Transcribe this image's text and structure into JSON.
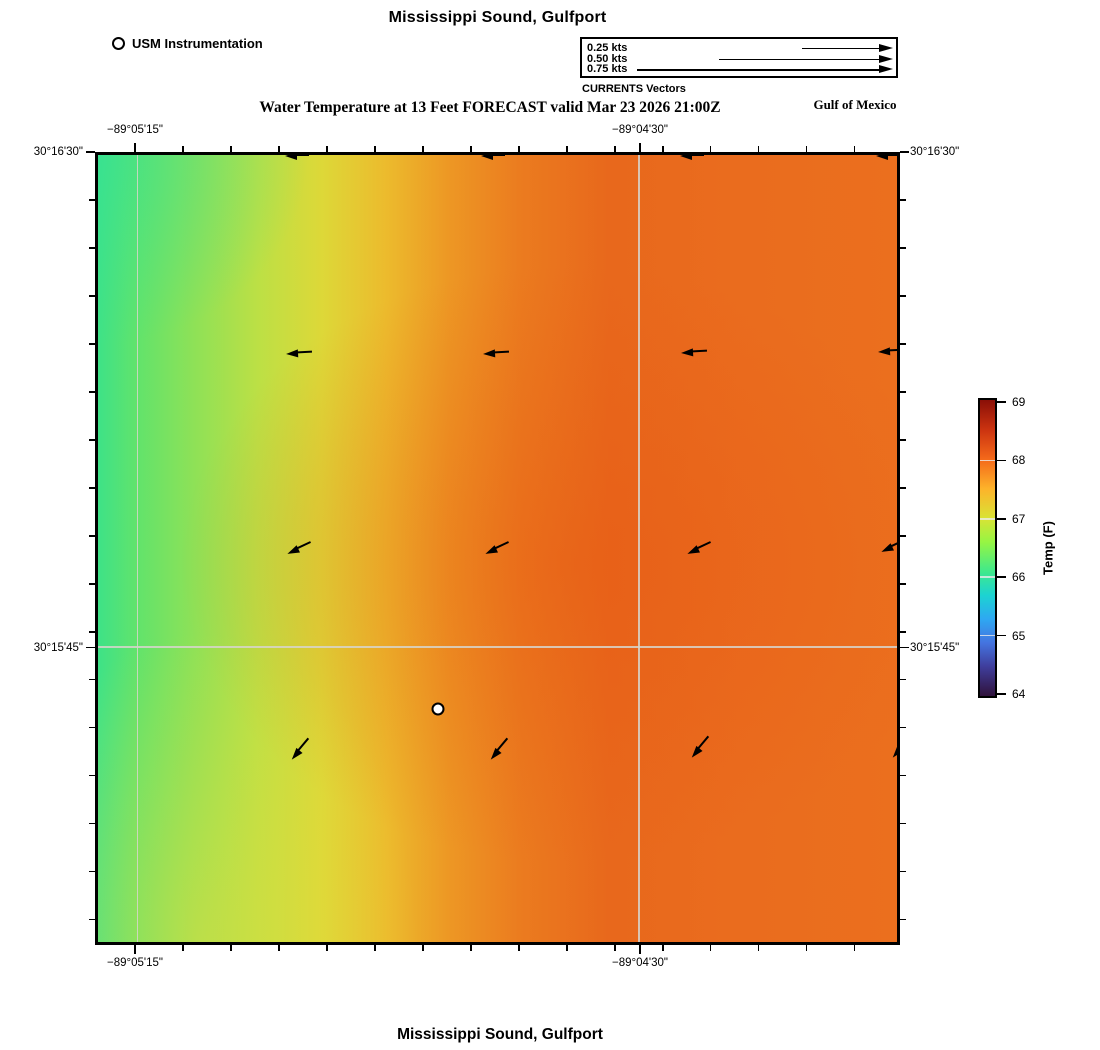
{
  "header": {
    "title": "Mississippi Sound, Gulfport",
    "station_legend_label": "USM Instrumentation",
    "vector_legend": {
      "caption": "CURRENTS Vectors",
      "entries": [
        {
          "label": "0.25 kts",
          "length_px": 91
        },
        {
          "label": "0.50 kts",
          "length_px": 174
        },
        {
          "label": "0.75 kts",
          "length_px": 256
        }
      ]
    },
    "subtitle": "Water Temperature at 13 Feet FORECAST valid Mar 23 2026 21:00Z",
    "region_label": "Gulf of Mexico"
  },
  "footer": {
    "title": "Mississippi Sound, Gulfport"
  },
  "chart_data": {
    "type": "heatmap",
    "title": "Mississippi Sound, Gulfport",
    "subtitle": "Water Temperature at 13 Feet FORECAST valid Mar 23 2026 21:00Z",
    "region_label": "Gulf of Mexico",
    "x_axis": {
      "major_ticks": [
        {
          "label": "−89°05'15\"",
          "f": 0.0497
        },
        {
          "label": "−89°04'30\"",
          "f": 0.677
        }
      ],
      "minor_tick_step_f": 0.0596
    },
    "y_axis": {
      "major_ticks": [
        {
          "label": "30°16'30\"",
          "f": 0.0
        },
        {
          "label": "30°15'45\"",
          "f": 0.625
        }
      ],
      "minor_tick_step_f": 0.0605
    },
    "colorbar": {
      "label": "Temp (F)",
      "min": 64,
      "max": 69,
      "ticks": [
        64,
        65,
        66,
        67,
        68,
        69
      ],
      "gradient_stops": [
        {
          "t": 0.0,
          "color": "#30123b"
        },
        {
          "t": 0.1,
          "color": "#3f3e9c"
        },
        {
          "t": 0.18,
          "color": "#4474e0"
        },
        {
          "t": 0.26,
          "color": "#2ea8f2"
        },
        {
          "t": 0.34,
          "color": "#1cd3d2"
        },
        {
          "t": 0.42,
          "color": "#3fe98c"
        },
        {
          "t": 0.52,
          "color": "#96f543"
        },
        {
          "t": 0.6,
          "color": "#d9e335"
        },
        {
          "t": 0.7,
          "color": "#fdb32a"
        },
        {
          "t": 0.8,
          "color": "#f4691a"
        },
        {
          "t": 0.9,
          "color": "#cb3310"
        },
        {
          "t": 1.0,
          "color": "#8a0f07"
        }
      ]
    },
    "temperature_field": {
      "base_stops": [
        {
          "f": 0.0,
          "color": "#3ee287"
        },
        {
          "f": 0.05,
          "color": "#62e36b"
        },
        {
          "f": 0.12,
          "color": "#8ee157"
        },
        {
          "f": 0.2,
          "color": "#bce045"
        },
        {
          "f": 0.28,
          "color": "#ddd838"
        },
        {
          "f": 0.36,
          "color": "#ecbb2d"
        },
        {
          "f": 0.44,
          "color": "#ed9724"
        },
        {
          "f": 0.53,
          "color": "#eb7b1f"
        },
        {
          "f": 0.64,
          "color": "#e8681c"
        },
        {
          "f": 0.8,
          "color": "#ea6c1e"
        },
        {
          "f": 1.0,
          "color": "#eb6f1e"
        }
      ],
      "overlays": [
        "radial-gradient(ellipse 300px 270px at 0% 0%, rgba(52,226,152,0.55) 0%, rgba(52,226,152,0) 70%)",
        "radial-gradient(ellipse 300px 430px at 13% 100%, rgba(229,221,61,0.5) 0%, rgba(229,221,61,0) 72%)",
        "radial-gradient(ellipse 520px 400px at 59% 52%, rgba(231,84,18,0.4) 0%, rgba(231,84,18,0) 75%)"
      ]
    },
    "current_vectors": [
      {
        "fx": 0.2335,
        "fy": 0.0,
        "heading_deg_math": 180,
        "length_px": 24
      },
      {
        "fx": 0.4795,
        "fy": 0.0,
        "heading_deg_math": 180,
        "length_px": 24
      },
      {
        "fx": 0.728,
        "fy": 0.0,
        "heading_deg_math": 180,
        "length_px": 24
      },
      {
        "fx": 0.974,
        "fy": 0.0,
        "heading_deg_math": 180,
        "length_px": 24
      },
      {
        "fx": 0.2355,
        "fy": 0.251,
        "heading_deg_math": 183,
        "length_px": 26
      },
      {
        "fx": 0.4815,
        "fy": 0.251,
        "heading_deg_math": 183,
        "length_px": 26
      },
      {
        "fx": 0.73,
        "fy": 0.25,
        "heading_deg_math": 183,
        "length_px": 26
      },
      {
        "fx": 0.976,
        "fy": 0.249,
        "heading_deg_math": 183,
        "length_px": 26
      },
      {
        "fx": 0.236,
        "fy": 0.506,
        "heading_deg_math": 205,
        "length_px": 26
      },
      {
        "fx": 0.484,
        "fy": 0.506,
        "heading_deg_math": 205,
        "length_px": 26
      },
      {
        "fx": 0.737,
        "fy": 0.506,
        "heading_deg_math": 205,
        "length_px": 26
      },
      {
        "fx": 0.98,
        "fy": 0.503,
        "heading_deg_math": 205,
        "length_px": 26
      },
      {
        "fx": 0.242,
        "fy": 0.767,
        "heading_deg_math": 230,
        "length_px": 27
      },
      {
        "fx": 0.491,
        "fy": 0.767,
        "heading_deg_math": 230,
        "length_px": 27
      },
      {
        "fx": 0.742,
        "fy": 0.765,
        "heading_deg_math": 230,
        "length_px": 27
      },
      {
        "fx": 0.994,
        "fy": 0.765,
        "heading_deg_math": 230,
        "length_px": 27
      }
    ],
    "station": {
      "fx": 0.425,
      "fy": 0.704
    }
  }
}
